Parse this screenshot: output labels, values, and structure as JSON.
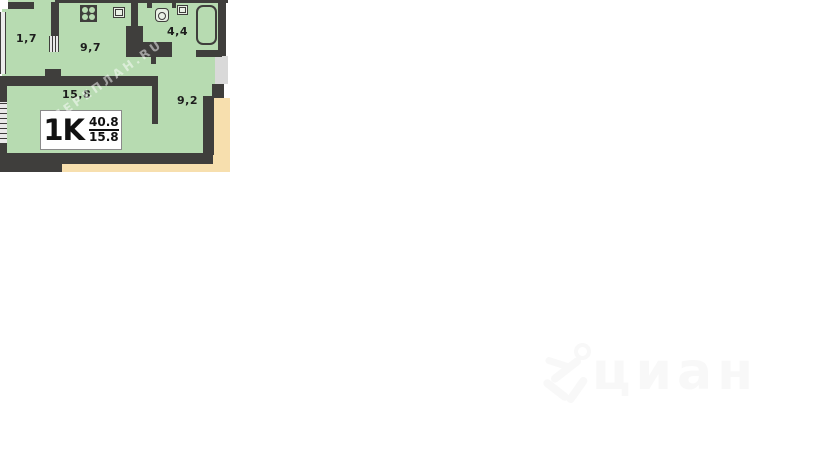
{
  "plan": {
    "rooms": [
      {
        "id": "balcony",
        "label": "1,7"
      },
      {
        "id": "kitchen",
        "label": "9,7"
      },
      {
        "id": "bathroom",
        "label": "4,4"
      },
      {
        "id": "living-room",
        "label": "15,8"
      },
      {
        "id": "hallway",
        "label": "9,2"
      }
    ],
    "tag": {
      "type": "1K",
      "area_total": "40.8",
      "area_living": "15.8"
    },
    "colors": {
      "room_fill": "#b7dbb1",
      "wall": "#3f3e3c",
      "outside": "#f7dfae",
      "window_gray": "#d9d9d9",
      "fixture_fill": "#e9f0e5",
      "label_box_border": "#8a8a8a",
      "text": "#1d1d1d",
      "diag_wm": "#ffffff",
      "brand_wm": "#f8f8f8"
    }
  },
  "watermarks": {
    "diagonal": "ПЕРЕПЛАН.RU",
    "brand": "циан"
  }
}
